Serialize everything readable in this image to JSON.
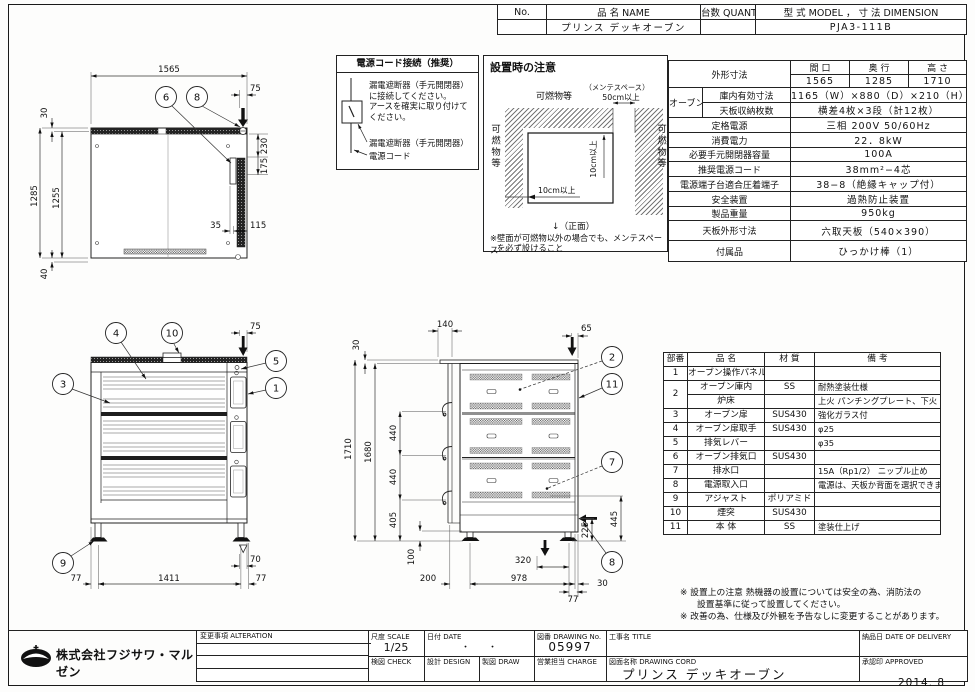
{
  "meta": {
    "date_stamp": "2014. 8"
  },
  "header_table": {
    "col_no": "No.",
    "col_name": "品 名 NAME",
    "col_qty": "台数 QUANTITY",
    "col_model": "型 式 MODEL ， 寸 法 DIMENSION",
    "val_no": "",
    "val_name": "プリンス デッキオーブン",
    "val_qty": "",
    "val_model": "PJA3-111B"
  },
  "power_cord_box": {
    "title": "電源コード接続（推奨）",
    "line1": "漏電遮断器（手元開閉器）",
    "line2": "に接続してください。",
    "line3": "アースを確実に取り付けて",
    "line4": "ください。",
    "label_breaker": "漏電遮断器（手元開閉器）",
    "label_cord": "電源コード"
  },
  "install_box": {
    "title": "設置時の注意",
    "top_label": "可燃物等",
    "maint_label": "（メンテスペース）",
    "maint_value": "50cm以上",
    "left_label": "可燃物等",
    "right_label": "可燃物等",
    "gap_v": "10cm以上",
    "gap_h": "10cm以上",
    "front_label": "↓（正面）",
    "note1": "※壁面が可燃物以外の場合でも、メンテスペース",
    "note2": "を必ず設けること"
  },
  "spec_table": {
    "outer_label": "外形寸法",
    "c1": "間 口",
    "c2": "奥 行",
    "c3": "高 さ",
    "v1": "1565",
    "v2": "1285",
    "v3": "1710",
    "oven_label": "オーブン",
    "inner_label": "庫内有効寸法",
    "inner_value": "1165（W）×880（D）×210（H）×3",
    "tray_label": "天板収納枚数",
    "tray_value": "横差4枚×3段（計12枚）",
    "rows": [
      {
        "label": "定格電源",
        "value": "三相 200V 50/60Hz"
      },
      {
        "label": "消費電力",
        "value": "22．8kW"
      },
      {
        "label": "必要手元開閉器容量",
        "value": "100A"
      },
      {
        "label": "推奨電源コード",
        "value": "38mm²−4芯"
      },
      {
        "label": "電源端子台適合圧着端子",
        "value": "38−8（絶縁キャップ付）"
      },
      {
        "label": "安全装置",
        "value": "過熱防止装置"
      },
      {
        "label": "製品重量",
        "value": "950kg"
      },
      {
        "label": "天板外形寸法",
        "value": "六取天板（540×390）"
      },
      {
        "label": "付属品",
        "value": "ひっかけ棒（1）"
      }
    ]
  },
  "parts_table": {
    "h_no": "部番",
    "h_name": "品 名",
    "h_mat": "材 質",
    "h_note": "備 考",
    "rows": [
      {
        "no": "1",
        "name": "オーブン操作パネル",
        "mat": "",
        "note": ""
      },
      {
        "no": "2",
        "name": "オーブン庫内",
        "mat": "SS",
        "note": "耐熱塗装仕様"
      },
      {
        "no": "",
        "name": "炉床",
        "mat": "",
        "note": "上火 パンチングプレート、下火 SS"
      },
      {
        "no": "3",
        "name": "オーブン扉",
        "mat": "SUS430",
        "note": "強化ガラス付"
      },
      {
        "no": "4",
        "name": "オーブン扉取手",
        "mat": "SUS430",
        "note": "φ25"
      },
      {
        "no": "5",
        "name": "排気レバー",
        "mat": "",
        "note": "φ35"
      },
      {
        "no": "6",
        "name": "オーブン排気口",
        "mat": "SUS430",
        "note": ""
      },
      {
        "no": "7",
        "name": "排水口",
        "mat": "",
        "note": "15A（Rp1/2） ニップル止め"
      },
      {
        "no": "8",
        "name": "電源取入口",
        "mat": "",
        "note": "電源は、天板か背面を選択できます"
      },
      {
        "no": "9",
        "name": "アジャスト",
        "mat": "ポリアミド",
        "note": ""
      },
      {
        "no": "10",
        "name": "煙突",
        "mat": "SUS430",
        "note": ""
      },
      {
        "no": "11",
        "name": "本 体",
        "mat": "SS",
        "note": "塗装仕上げ"
      }
    ]
  },
  "footnotes": {
    "line1": "※ 設置上の注意 熱機器の設置については安全の為、消防法の",
    "line2": "設置基準に従って設置してください。",
    "line3": "※ 改善の為、仕様及び外観を予告なしに変更することがあります。"
  },
  "title_block": {
    "alteration": "変更事項 ALTERATION",
    "scale_label": "尺度 SCALE",
    "scale_value": "1/25",
    "date_label": "日付 DATE",
    "date_value": "・　　・",
    "dwg_label": "図番 DRAWING No.",
    "dwg_value": "05997",
    "title_label": "工事名 TITLE",
    "check_label": "検図 CHECK",
    "design_label": "設計 DESIGN",
    "draw_label": "製図 DRAW",
    "charge_label": "営業担当 CHARGE",
    "name_label": "図面名称 DRAWING CORD",
    "name_value": "プリンス デッキオーブン",
    "delivery_label": "納品日 DATE OF DELIVERY",
    "approved_label": "承認印 APPROVED",
    "company": "株式会社フジサワ・マルゼン"
  },
  "views": {
    "plan": {
      "d_width": "1565",
      "d_inset": "75",
      "d_top": "30",
      "d_depth": "1285",
      "d_inner": "1255",
      "d_r1": "230",
      "d_r2": "175",
      "d_b1": "35",
      "d_b2": "115",
      "d_bottom": "40",
      "balloons": [
        "6",
        "8"
      ]
    },
    "front": {
      "d_inset": "75",
      "d_adj": "70",
      "d_left": "77",
      "d_span": "1411",
      "d_right": "77",
      "balloons": [
        "4",
        "10",
        "5",
        "1",
        "3",
        "9"
      ]
    },
    "side": {
      "d_chimney": "140",
      "d_top": "30",
      "d_inset": "65",
      "d_h1": "1710",
      "d_h2": "1680",
      "d_p1": "440",
      "d_p2": "440",
      "d_p3": "405",
      "d_leg": "100",
      "d_rear": "200",
      "d_span": "978",
      "d_front": "30",
      "d_foot": "77",
      "d_inlet": "320",
      "d_v1": "225",
      "d_v2": "445",
      "balloons": [
        "2",
        "11",
        "7",
        "8"
      ]
    }
  }
}
